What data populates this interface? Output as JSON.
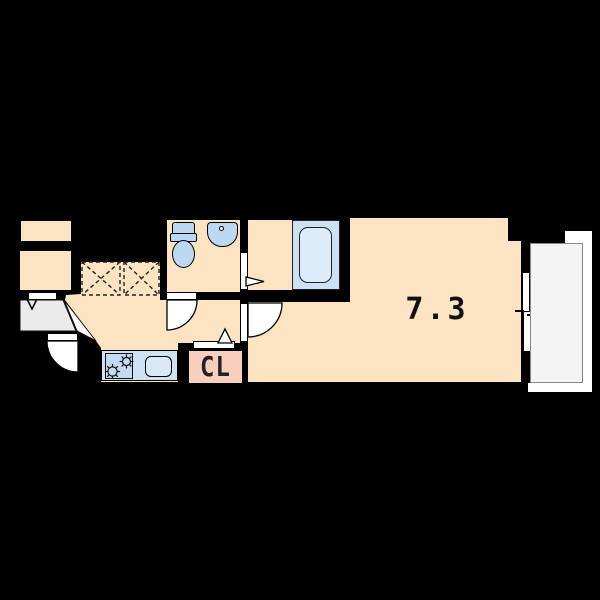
{
  "floorplan": {
    "background": "#000000",
    "floor_color": "#fce3c1",
    "main_room": {
      "label": "7.3"
    },
    "closet": {
      "label": "CL"
    },
    "colors": {
      "fixture_blue": "#bcd8f2",
      "counter_blue": "#cfe2f5",
      "stove_blue": "#c3daf2",
      "sink_blue": "#d9e9f8",
      "tub_surround_blue": "#cde1f5",
      "tub_inner_blue": "#ddecfb",
      "closet_pink": "#f7cfbc",
      "entry_gray": "#ebebeb",
      "balcony_gray": "#f4f4f4",
      "door_white": "#ffffff",
      "line_black": "#000000"
    },
    "fixtures": [
      "toilet",
      "wash-basin",
      "bathtub",
      "kitchen-stove",
      "kitchen-sink",
      "closet",
      "balcony",
      "sliding-window",
      "entrance-door",
      "dashed-storage-space"
    ]
  }
}
